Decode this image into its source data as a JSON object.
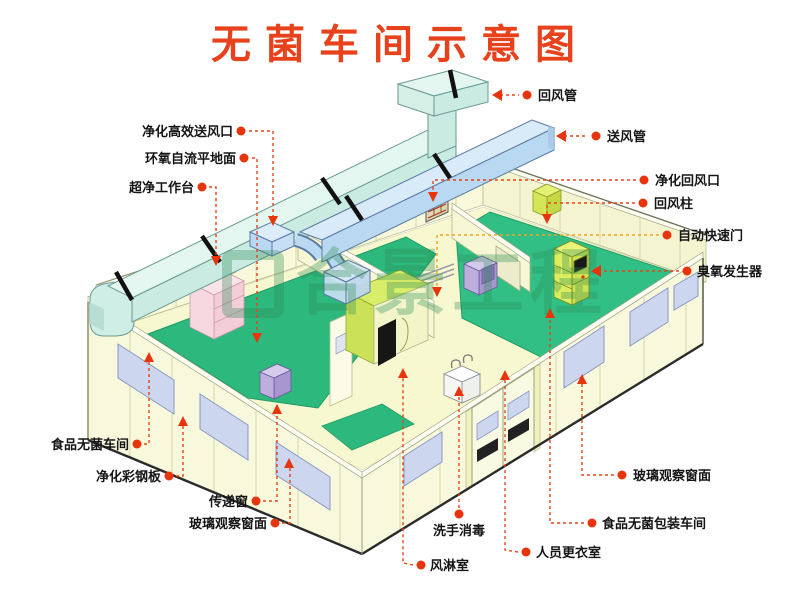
{
  "title": "无菌车间示意图",
  "watermark": {
    "text": "合景工程"
  },
  "callouts": {
    "left": [
      {
        "text": "净化高效送风口"
      },
      {
        "text": "环氧自流平地面"
      },
      {
        "text": "超净工作台"
      },
      {
        "text": "食品无菌车间"
      },
      {
        "text": "净化彩钢板"
      },
      {
        "text": "传递窗"
      },
      {
        "text": "玻璃观察窗面"
      }
    ],
    "right": [
      {
        "text": "回风管"
      },
      {
        "text": "送风管"
      },
      {
        "text": "净化回风口"
      },
      {
        "text": "回风柱"
      },
      {
        "text": "自动快速门"
      },
      {
        "text": "臭氧发生器"
      },
      {
        "text": "玻璃观察窗面"
      },
      {
        "text": "食品无菌包装车间"
      },
      {
        "text": "人员更衣室"
      }
    ],
    "bottom": [
      {
        "text": "洗手消毒"
      },
      {
        "text": "风淋室"
      }
    ]
  },
  "colors": {
    "title_red": "#e8421c",
    "leader_red": "#e84315",
    "leader_orange": "#eda427",
    "floor_green": "#2db87d",
    "floor_green_bright": "#31bf85",
    "wall_yellow": "#f8f9dc",
    "duct_return_cyan": "#c9ebe2",
    "duct_supply_blue": "#b9d9f2",
    "window_lavender": "#ccd6ee",
    "airshower_chartreuse": "#d8ee6a",
    "workbench_pink": "#f3cdd8",
    "passbox_purple": "#a796cf",
    "watermark_green": "#2e8c55"
  }
}
